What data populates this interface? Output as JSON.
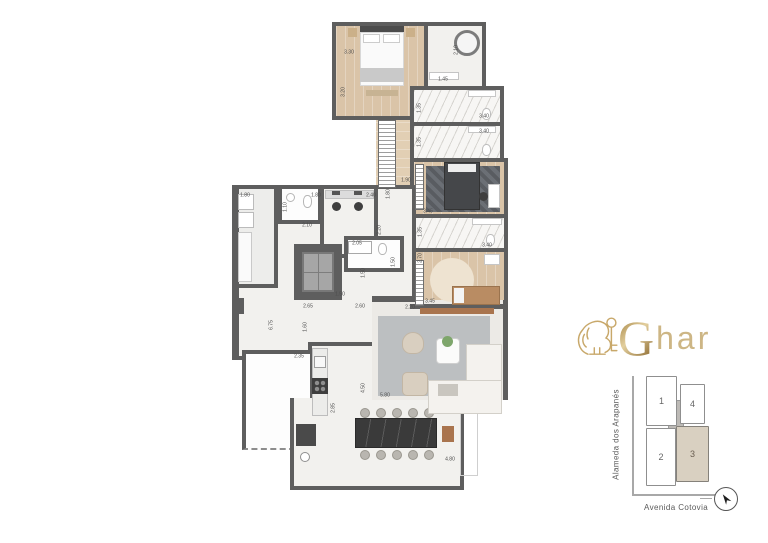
{
  "brand": {
    "g": "G",
    "rest": "har",
    "icon": "lion-with-key"
  },
  "key_plan": {
    "street_left": "Alameda dos Arapanés",
    "street_bottom": "Avenida Cotovia",
    "units": [
      {
        "number": "1",
        "highlighted": false
      },
      {
        "number": "4",
        "highlighted": false
      },
      {
        "number": "2",
        "highlighted": false
      },
      {
        "number": "3",
        "highlighted": true
      }
    ],
    "highlight_color": "#d9d0c1",
    "compass": "north-arrow"
  },
  "floor_plan": {
    "wall_color": "#5e5e5e",
    "dimensions": [
      {
        "text": "3.30"
      },
      {
        "text": "3.20"
      },
      {
        "text": "2.10"
      },
      {
        "text": "1.45"
      },
      {
        "text": "1.35"
      },
      {
        "text": "3.40"
      },
      {
        "text": "1.35"
      },
      {
        "text": "3.40"
      },
      {
        "text": "1.90"
      },
      {
        "text": "1.80"
      },
      {
        "text": "2.40"
      },
      {
        "text": "2.20"
      },
      {
        "text": "1.80"
      },
      {
        "text": "1.80"
      },
      {
        "text": "1.10"
      },
      {
        "text": "2.10"
      },
      {
        "text": "3.45"
      },
      {
        "text": "1.35"
      },
      {
        "text": "3.40"
      },
      {
        "text": "2.70"
      },
      {
        "text": "3.45"
      },
      {
        "text": "2.05"
      },
      {
        "text": "1.50"
      },
      {
        "text": "1.50"
      },
      {
        "text": "1.50"
      },
      {
        "text": "2.65"
      },
      {
        "text": "2.60"
      },
      {
        "text": "2.20"
      },
      {
        "text": "6.75"
      },
      {
        "text": "1.60"
      },
      {
        "text": "2.35"
      },
      {
        "text": "4.50"
      },
      {
        "text": "5.80"
      },
      {
        "text": "2.85"
      },
      {
        "text": "4.80"
      }
    ]
  }
}
